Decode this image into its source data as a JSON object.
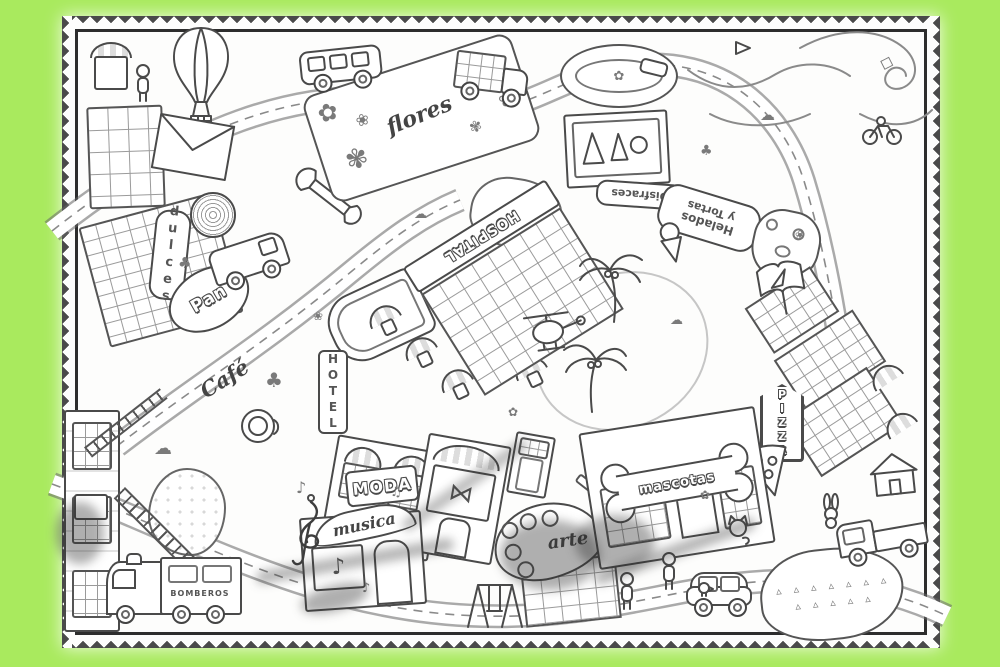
{
  "scene": {
    "background_color": "#a9ea5e",
    "paper_color": "#fdfdfc",
    "ink_color": "#3a3a3a",
    "description": "Giant black-and-white city colouring poster on a bright green background"
  },
  "signs": {
    "dulces": "dulces",
    "pan": "Pan",
    "cafe": "Café",
    "hospital": "HOSPITAL",
    "flores": "flores",
    "disfraces": "Disfraces",
    "helados_line1": "Helados",
    "helados_line2": "y Tortas",
    "hotel": "HOTEL",
    "moda": "MODA",
    "musica": "musica",
    "arte": "arte",
    "mascotas": "mascotas",
    "bomberos": "BOMBEROS",
    "pizza": "PIZZA"
  },
  "icons": {
    "flower": "✿",
    "blossom": "❀",
    "petal": "✾",
    "note": "♪",
    "notes": "♫",
    "cloud": "☁",
    "bush": "♣",
    "sprout": "▵",
    "bowtie": "⋈",
    "diamond": "◇"
  }
}
